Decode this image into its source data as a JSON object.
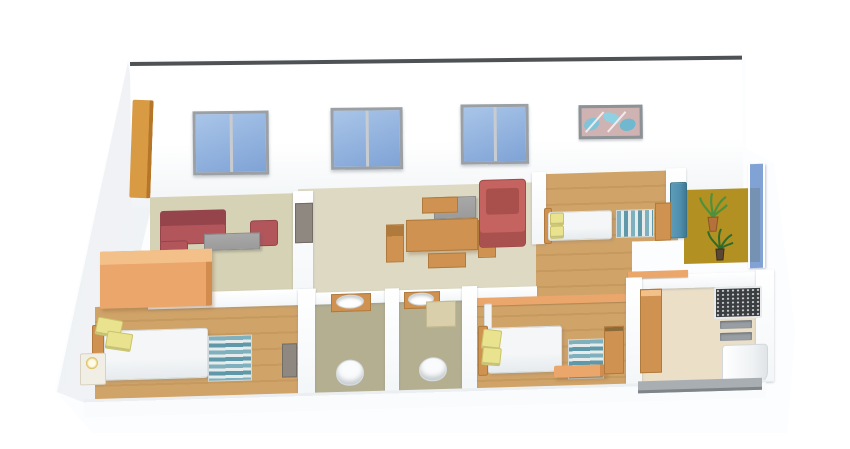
{
  "app": {
    "type": "3D floor plan render",
    "view": "isometric cutaway",
    "unit": "3BHK apartment"
  },
  "colors": {
    "bg": "#ffffff",
    "wall-top": "#4e5254",
    "window-frame": "#9aa0a5",
    "window-glass": "#7fa3d6",
    "glass-light": "#a9c5e8",
    "door-frame": "#d89a42",
    "floor-olive": "#d6d2b5",
    "floor-beige": "#ddd9c3",
    "floor-wood": "#d0a368",
    "floor-bath": "#b4af90",
    "floor-balcony": "#b39022",
    "floor-kitchen": "#ebdfc7",
    "sofa-red": "#b2565c",
    "sofa-red-dark": "#94444a",
    "armchair-red": "#c4635f",
    "table-grey": "#9b9b9b",
    "wood": "#cf9250",
    "wood-dark": "#b07a3c",
    "wardrobe": "#eba76b",
    "wardrobe-top": "#f4c08a",
    "pillow": "#e9e38f",
    "pillow-edge": "#c9c26a",
    "rug-teal": "#7fb0bd",
    "rug-light": "#e6ecec",
    "rug-blue": "#5f98a8",
    "granite": "#3b3e40",
    "vent-grey": "#989ea3",
    "band-grey": "#a9aeb3",
    "railing-blue": "#6b92cc",
    "plant-green": "#4f913b",
    "plant-dark": "#2f6b2a",
    "pot-orange": "#b5713c",
    "pot-dark": "#5a4632",
    "cabinet-grey": "#8e8880",
    "art-bg": "#cfb3b3",
    "art-blue": "#7fc4d8",
    "base-white": "#fcfdfe"
  },
  "scene": {
    "back_wall": {
      "windows": [
        {
          "id": "window-1",
          "panes": 2
        },
        {
          "id": "window-2",
          "panes": 2
        },
        {
          "id": "window-3",
          "panes": 2
        }
      ],
      "artwork": "abstract blue-leaf painting",
      "door_frame": "orange frame, far left"
    },
    "rooms": [
      {
        "name": "living-room",
        "floor": "olive",
        "furniture": [
          "red L-sofa",
          "red armchair",
          "grey coffee table",
          "tv cabinet"
        ]
      },
      {
        "name": "dining-room",
        "floor": "beige",
        "furniture": [
          "wooden dining table",
          "side chairs",
          "benches",
          "grey sideboard",
          "red lounge chair"
        ]
      },
      {
        "name": "bedroom-top-right",
        "floor": "wood",
        "furniture": [
          "double bed",
          "yellow pillows",
          "striped rug",
          "side dresser",
          "blue door"
        ]
      },
      {
        "name": "balcony",
        "floor": "mustard",
        "furniture": [
          "potted palm",
          "potted plant",
          "blue glass railing"
        ]
      },
      {
        "name": "bedroom-bottom-left",
        "floor": "wood",
        "furniture": [
          "orange wardrobe",
          "double bed",
          "yellow pillows",
          "nightstand with lamp",
          "striped rug",
          "dark dresser"
        ]
      },
      {
        "name": "bathroom-1",
        "floor": "olive-grey",
        "furniture": [
          "wash basin",
          "toilet"
        ]
      },
      {
        "name": "bathroom-2",
        "floor": "olive-grey",
        "furniture": [
          "wash basin",
          "beige cabinet",
          "toilet"
        ]
      },
      {
        "name": "bedroom-bottom-middle",
        "floor": "wood",
        "furniture": [
          "double bed",
          "yellow pillows",
          "bedside lamp",
          "striped rug",
          "orange bench",
          "dresser"
        ]
      },
      {
        "name": "kitchen",
        "floor": "cream",
        "furniture": [
          "wooden cabinet run",
          "granite counter",
          "two vents",
          "white sink unit",
          "front grey sill"
        ]
      }
    ]
  }
}
